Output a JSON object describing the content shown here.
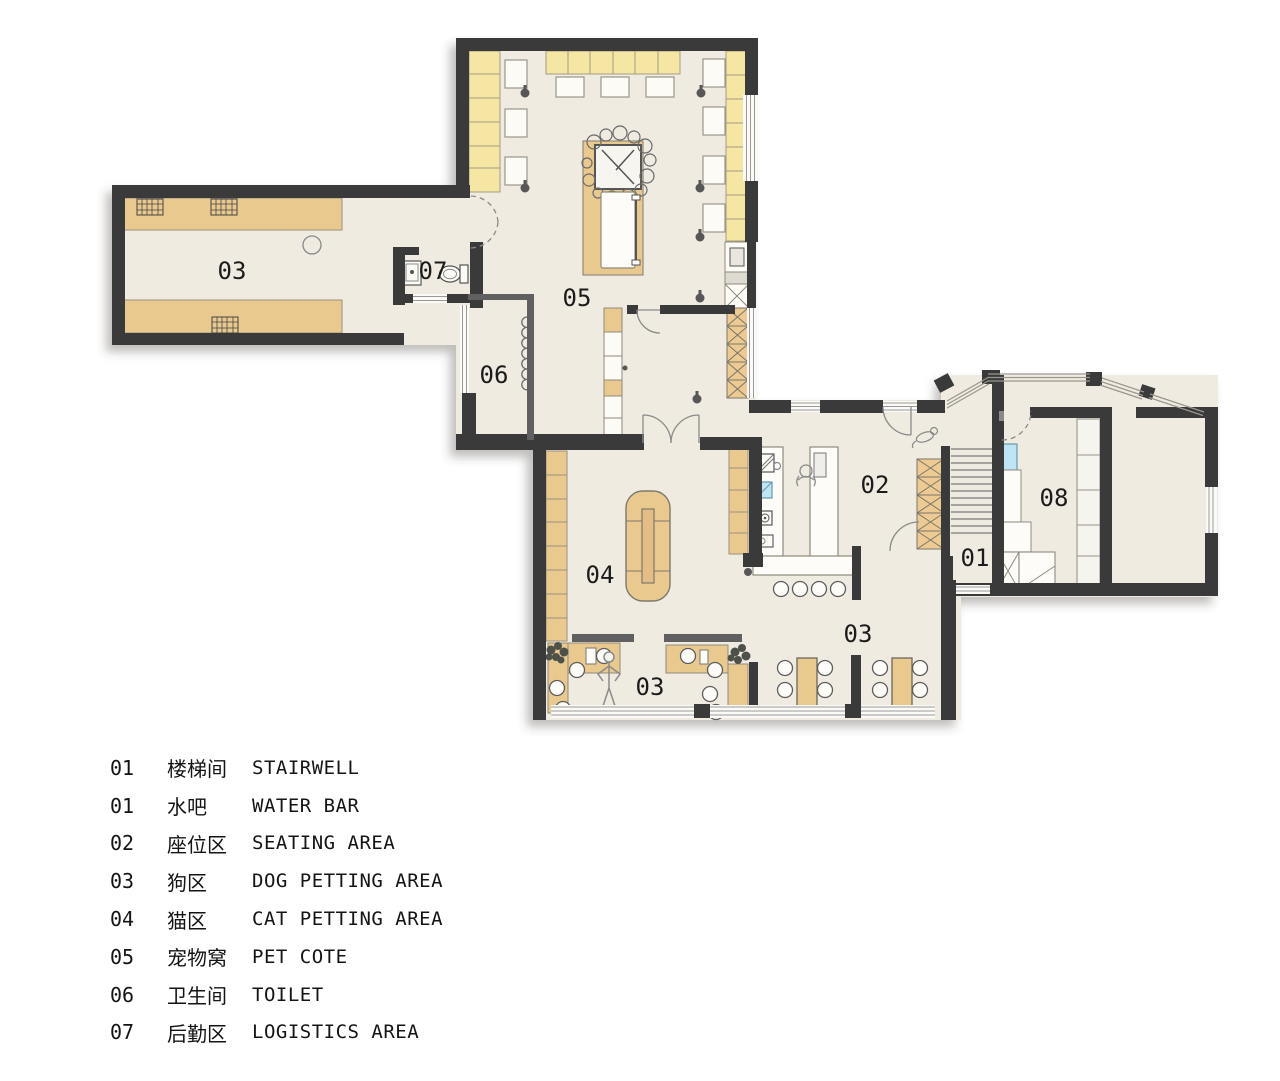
{
  "colors": {
    "background": "#ffffff",
    "wall": "#3a3a3a",
    "wall_gray": "#606060",
    "floor": "#f0ebe1",
    "accent_yellow": "#f6e6a4",
    "accent_tan": "#eac98f",
    "accent_blue": "#bfe4f3"
  },
  "rooms": [
    {
      "name": "dog-petting-area-west",
      "label": "03"
    },
    {
      "name": "logistics-area",
      "label": "07"
    },
    {
      "name": "pet-cote",
      "label": "05"
    },
    {
      "name": "toilet",
      "label": "06"
    },
    {
      "name": "cat-petting-area",
      "label": "04"
    },
    {
      "name": "seating-area",
      "label": "02"
    },
    {
      "name": "stairwell",
      "label": "01"
    },
    {
      "name": "room-08",
      "label": "08"
    },
    {
      "name": "dog-petting-area-south",
      "label": "03"
    },
    {
      "name": "dog-petting-area-east",
      "label": "03"
    }
  ],
  "legend": {
    "rows": [
      {
        "code": "01",
        "zh": "楼梯间",
        "en": "STAIRWELL"
      },
      {
        "code": "01",
        "zh": "水吧",
        "en": "WATER BAR"
      },
      {
        "code": "02",
        "zh": "座位区",
        "en": "SEATING AREA"
      },
      {
        "code": "03",
        "zh": "狗区",
        "en": "DOG PETTING AREA"
      },
      {
        "code": "04",
        "zh": "猫区",
        "en": "CAT PETTING AREA"
      },
      {
        "code": "05",
        "zh": "宠物窝",
        "en": "PET COTE"
      },
      {
        "code": "06",
        "zh": "卫生间",
        "en": "TOILET"
      },
      {
        "code": "07",
        "zh": "后勤区",
        "en": "LOGISTICS AREA"
      }
    ]
  }
}
